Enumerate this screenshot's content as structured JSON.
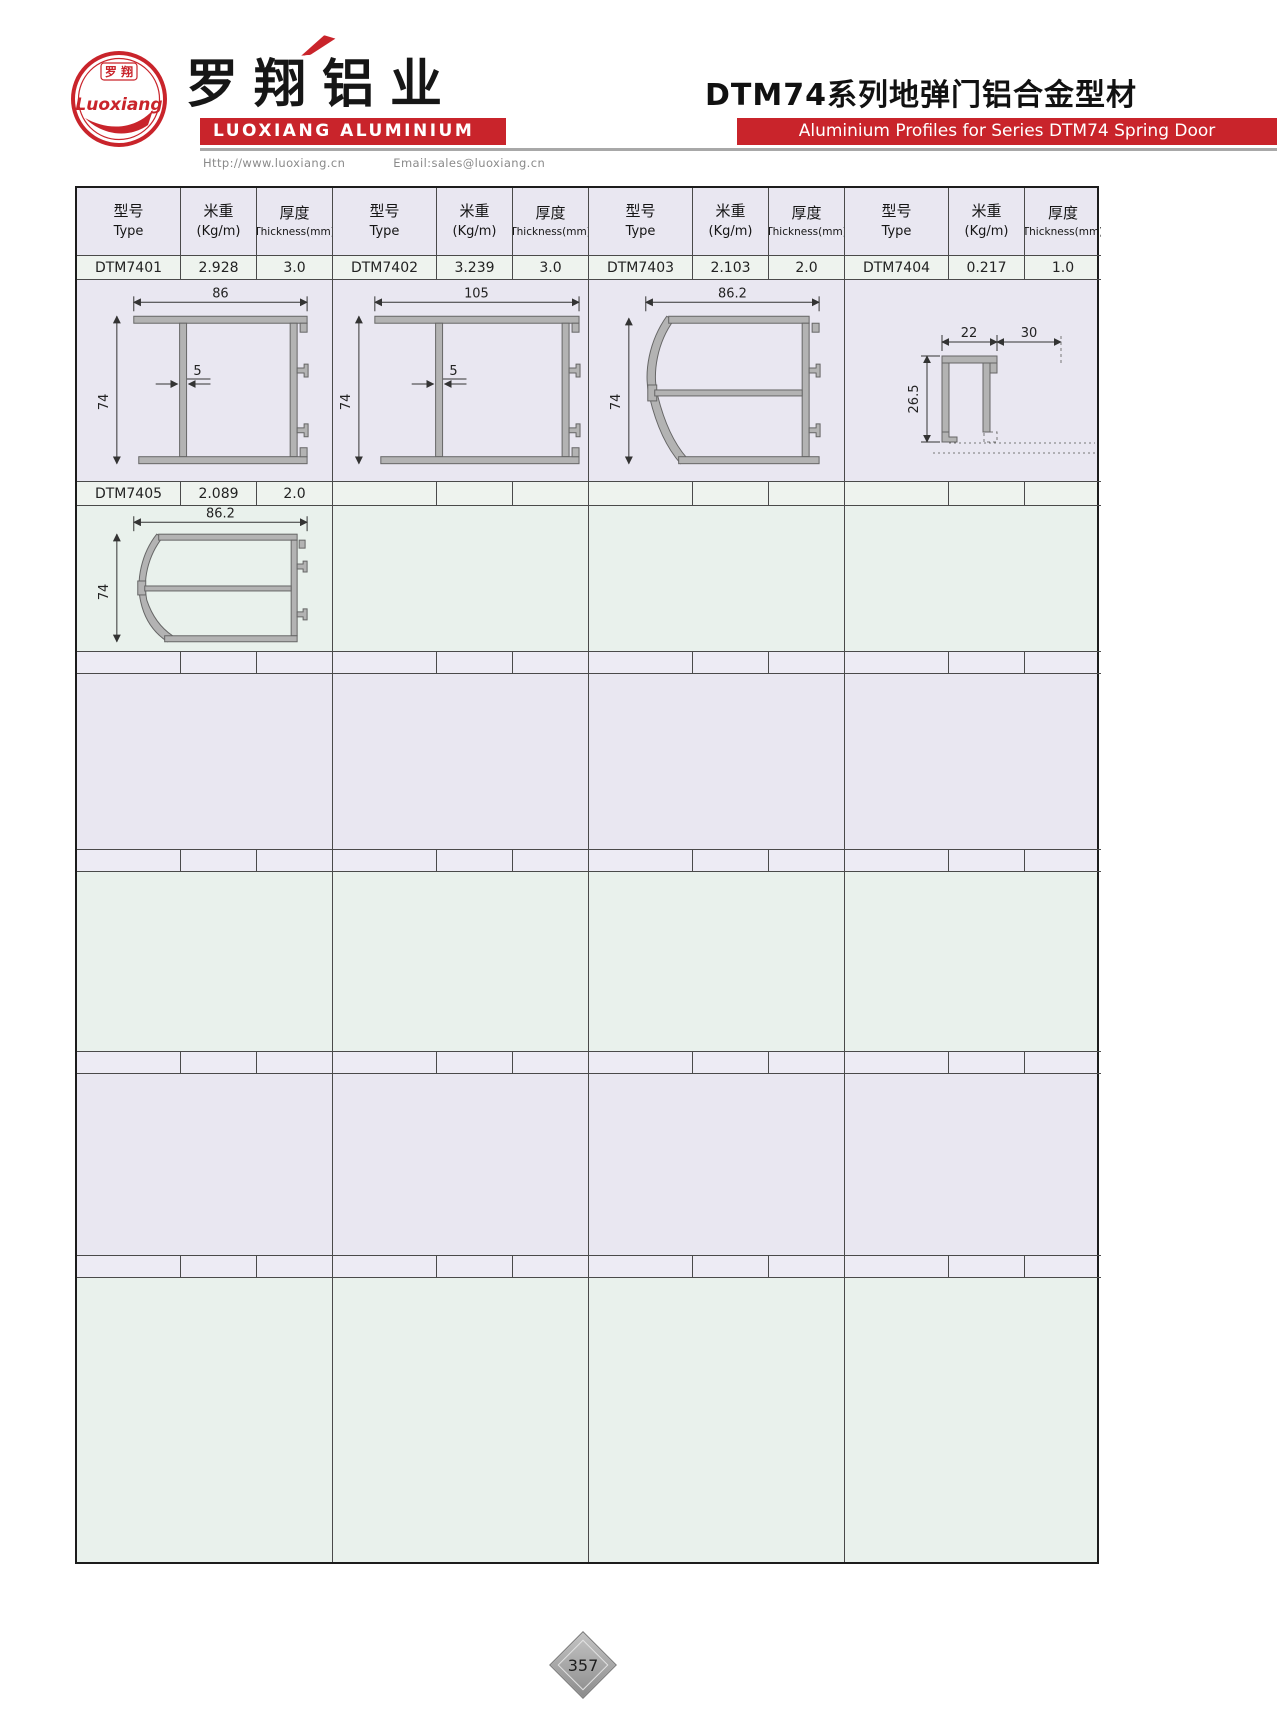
{
  "header": {
    "logo": {
      "seal_line1": "罗 翔",
      "seal_script": "Luoxiang"
    },
    "brand_cn": "罗翔铝业",
    "brand_en": "LUOXIANG ALUMINIUM",
    "website": "Http://www.luoxiang.cn",
    "email": "Email:sales@luoxiang.cn",
    "series_title_cn": "DTM74系列地弹门铝合金型材",
    "series_title_en": "Aluminium Profiles for Series DTM74 Spring Door"
  },
  "table": {
    "col_headers": {
      "type_cn": "型号",
      "type_en": "Type",
      "weight_cn": "米重",
      "weight_en": "(Kg/m)",
      "thickness_cn": "厚度",
      "thickness_en": "Thickness(mm)"
    },
    "profiles": [
      {
        "type": "DTM7401",
        "weight": "2.928",
        "thickness": "3.0",
        "dims": {
          "width": "86",
          "web": "5",
          "height": "74"
        }
      },
      {
        "type": "DTM7402",
        "weight": "3.239",
        "thickness": "3.0",
        "dims": {
          "width": "105",
          "web": "5",
          "height": "74"
        }
      },
      {
        "type": "DTM7403",
        "weight": "2.103",
        "thickness": "2.0",
        "dims": {
          "width": "86.2",
          "height": "74"
        }
      },
      {
        "type": "DTM7404",
        "weight": "0.217",
        "thickness": "1.0",
        "dims": {
          "width": "22",
          "offset": "30",
          "height": "26.5"
        }
      },
      {
        "type": "DTM7405",
        "weight": "2.089",
        "thickness": "2.0",
        "dims": {
          "width": "86.2",
          "height": "74"
        }
      }
    ]
  },
  "footer": {
    "page_number": "357"
  },
  "colors": {
    "brand_red": "#c9242b",
    "band_lavender": "#e9e7f1",
    "band_green": "#e9f1ec",
    "row_light": "#eef3ee",
    "profile_gray": "#b3b3b3"
  }
}
